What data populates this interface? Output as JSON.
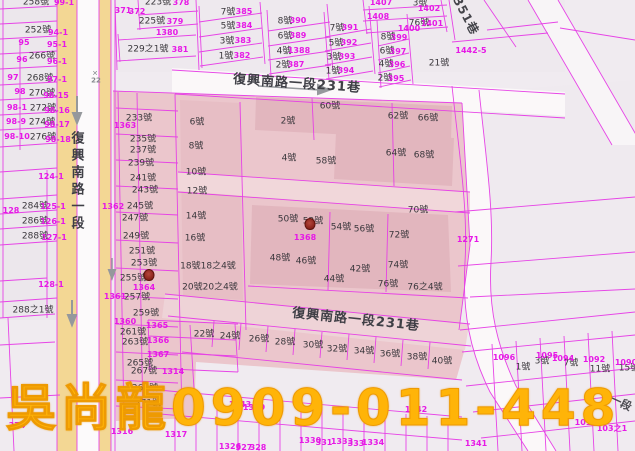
{
  "watermark": {
    "text": "吳尚龍0909-011-448",
    "color": "#ffb408"
  },
  "map_meta": {
    "highlight_color": "#ebc6cc",
    "parcel_line_color": "#e63ce6",
    "road_fill_color": "#f3d794",
    "house_label_color": "#3a373c",
    "lot_label_color": "#e619e6"
  },
  "markers": [
    {
      "x": 149,
      "y": 275
    },
    {
      "x": 310,
      "y": 224
    }
  ],
  "labels": [
    {
      "t": "復興南路一段",
      "x": 76,
      "y": 182,
      "k": "rv"
    },
    {
      "t": "復興南路一段231巷",
      "x": 297,
      "y": 84,
      "k": "road",
      "r": 4
    },
    {
      "t": "復興南路一段231巷",
      "x": 356,
      "y": 320,
      "k": "road",
      "r": 6
    },
    {
      "t": "351巷",
      "x": 466,
      "y": 16,
      "k": "lane",
      "r": 62
    },
    {
      "t": "一段",
      "x": 621,
      "y": 403,
      "k": "lane2",
      "r": 25
    },
    {
      "t": "✕",
      "x": 95,
      "y": 74,
      "k": "g"
    },
    {
      "t": "22",
      "x": 96,
      "y": 81,
      "k": "g"
    },
    {
      "t": "258號",
      "x": 36,
      "y": 3,
      "k": "h"
    },
    {
      "t": "252號",
      "x": 38,
      "y": 31,
      "k": "h"
    },
    {
      "t": "266號",
      "x": 42,
      "y": 57,
      "k": "h"
    },
    {
      "t": "268號",
      "x": 40,
      "y": 79,
      "k": "h"
    },
    {
      "t": "270號",
      "x": 42,
      "y": 94,
      "k": "h"
    },
    {
      "t": "272號",
      "x": 43,
      "y": 109,
      "k": "h"
    },
    {
      "t": "274號",
      "x": 42,
      "y": 123,
      "k": "h"
    },
    {
      "t": "276號",
      "x": 43,
      "y": 138,
      "k": "h"
    },
    {
      "t": "284號",
      "x": 35,
      "y": 207,
      "k": "h"
    },
    {
      "t": "286號",
      "x": 35,
      "y": 222,
      "k": "h"
    },
    {
      "t": "288號",
      "x": 35,
      "y": 237,
      "k": "h"
    },
    {
      "t": "288之1號",
      "x": 33,
      "y": 311,
      "k": "h"
    },
    {
      "t": "223號",
      "x": 158,
      "y": 3,
      "k": "h"
    },
    {
      "t": "225號",
      "x": 152,
      "y": 22,
      "k": "h"
    },
    {
      "t": "229之1號",
      "x": 148,
      "y": 50,
      "k": "h"
    },
    {
      "t": "233號",
      "x": 139,
      "y": 119,
      "k": "h"
    },
    {
      "t": "235號",
      "x": 143,
      "y": 140,
      "k": "h"
    },
    {
      "t": "237號",
      "x": 143,
      "y": 151,
      "k": "h"
    },
    {
      "t": "239號",
      "x": 141,
      "y": 164,
      "k": "h"
    },
    {
      "t": "241號",
      "x": 143,
      "y": 179,
      "k": "h"
    },
    {
      "t": "243號",
      "x": 145,
      "y": 191,
      "k": "h"
    },
    {
      "t": "245號",
      "x": 140,
      "y": 207,
      "k": "h"
    },
    {
      "t": "247號",
      "x": 135,
      "y": 219,
      "k": "h"
    },
    {
      "t": "249號",
      "x": 136,
      "y": 237,
      "k": "h"
    },
    {
      "t": "251號",
      "x": 142,
      "y": 252,
      "k": "h"
    },
    {
      "t": "253號",
      "x": 144,
      "y": 264,
      "k": "h"
    },
    {
      "t": "255號",
      "x": 133,
      "y": 279,
      "k": "h"
    },
    {
      "t": "257號",
      "x": 137,
      "y": 298,
      "k": "h"
    },
    {
      "t": "259號",
      "x": 146,
      "y": 314,
      "k": "h"
    },
    {
      "t": "261號",
      "x": 133,
      "y": 333,
      "k": "h"
    },
    {
      "t": "263號",
      "x": 135,
      "y": 343,
      "k": "h"
    },
    {
      "t": "265號",
      "x": 140,
      "y": 364,
      "k": "h"
    },
    {
      "t": "267號",
      "x": 144,
      "y": 372,
      "k": "h"
    },
    {
      "t": "269號",
      "x": 145,
      "y": 389,
      "k": "h"
    },
    {
      "t": "271號",
      "x": 148,
      "y": 404,
      "k": "h"
    },
    {
      "t": "6號",
      "x": 197,
      "y": 123,
      "k": "h"
    },
    {
      "t": "8號",
      "x": 196,
      "y": 147,
      "k": "h"
    },
    {
      "t": "10號",
      "x": 196,
      "y": 173,
      "k": "h"
    },
    {
      "t": "12號",
      "x": 197,
      "y": 192,
      "k": "h"
    },
    {
      "t": "14號",
      "x": 196,
      "y": 217,
      "k": "h"
    },
    {
      "t": "16號",
      "x": 195,
      "y": 239,
      "k": "h"
    },
    {
      "t": "18號18之4號",
      "x": 208,
      "y": 267,
      "k": "h"
    },
    {
      "t": "20號20之4號",
      "x": 210,
      "y": 288,
      "k": "h"
    },
    {
      "t": "2號",
      "x": 288,
      "y": 122,
      "k": "h"
    },
    {
      "t": "4號",
      "x": 289,
      "y": 159,
      "k": "h"
    },
    {
      "t": "58號",
      "x": 326,
      "y": 162,
      "k": "h"
    },
    {
      "t": "60號",
      "x": 330,
      "y": 107,
      "k": "h"
    },
    {
      "t": "62號",
      "x": 398,
      "y": 117,
      "k": "h"
    },
    {
      "t": "66號",
      "x": 428,
      "y": 119,
      "k": "h"
    },
    {
      "t": "64號",
      "x": 396,
      "y": 154,
      "k": "h"
    },
    {
      "t": "68號",
      "x": 424,
      "y": 156,
      "k": "h"
    },
    {
      "t": "70號",
      "x": 418,
      "y": 211,
      "k": "h"
    },
    {
      "t": "72號",
      "x": 399,
      "y": 236,
      "k": "h"
    },
    {
      "t": "50號",
      "x": 288,
      "y": 220,
      "k": "h"
    },
    {
      "t": "52號",
      "x": 313,
      "y": 222,
      "k": "h"
    },
    {
      "t": "54號",
      "x": 341,
      "y": 228,
      "k": "h"
    },
    {
      "t": "56號",
      "x": 364,
      "y": 230,
      "k": "h"
    },
    {
      "t": "48號",
      "x": 280,
      "y": 259,
      "k": "h"
    },
    {
      "t": "46號",
      "x": 306,
      "y": 262,
      "k": "h"
    },
    {
      "t": "42號",
      "x": 360,
      "y": 270,
      "k": "h"
    },
    {
      "t": "74號",
      "x": 398,
      "y": 266,
      "k": "h"
    },
    {
      "t": "44號",
      "x": 334,
      "y": 280,
      "k": "h"
    },
    {
      "t": "76號",
      "x": 388,
      "y": 285,
      "k": "h"
    },
    {
      "t": "76之4號",
      "x": 425,
      "y": 288,
      "k": "h"
    },
    {
      "t": "22號",
      "x": 204,
      "y": 335,
      "k": "h"
    },
    {
      "t": "24號",
      "x": 230,
      "y": 337,
      "k": "h"
    },
    {
      "t": "26號",
      "x": 259,
      "y": 340,
      "k": "h"
    },
    {
      "t": "28號",
      "x": 285,
      "y": 343,
      "k": "h"
    },
    {
      "t": "30號",
      "x": 313,
      "y": 346,
      "k": "h"
    },
    {
      "t": "32號",
      "x": 337,
      "y": 350,
      "k": "h"
    },
    {
      "t": "34號",
      "x": 364,
      "y": 352,
      "k": "h"
    },
    {
      "t": "36號",
      "x": 390,
      "y": 355,
      "k": "h"
    },
    {
      "t": "38號",
      "x": 417,
      "y": 358,
      "k": "h"
    },
    {
      "t": "40號",
      "x": 442,
      "y": 362,
      "k": "h"
    },
    {
      "t": "7號",
      "x": 228,
      "y": 13,
      "k": "h"
    },
    {
      "t": "5號",
      "x": 228,
      "y": 27,
      "k": "h"
    },
    {
      "t": "3號",
      "x": 227,
      "y": 42,
      "k": "h"
    },
    {
      "t": "1號",
      "x": 226,
      "y": 57,
      "k": "h"
    },
    {
      "t": "8號",
      "x": 285,
      "y": 22,
      "k": "h"
    },
    {
      "t": "6號",
      "x": 285,
      "y": 37,
      "k": "h"
    },
    {
      "t": "4號",
      "x": 284,
      "y": 52,
      "k": "h"
    },
    {
      "t": "2號",
      "x": 283,
      "y": 66,
      "k": "h"
    },
    {
      "t": "7號",
      "x": 337,
      "y": 29,
      "k": "h"
    },
    {
      "t": "5號",
      "x": 336,
      "y": 44,
      "k": "h"
    },
    {
      "t": "3號",
      "x": 334,
      "y": 58,
      "k": "h"
    },
    {
      "t": "1號",
      "x": 333,
      "y": 72,
      "k": "h"
    },
    {
      "t": "8號",
      "x": 388,
      "y": 38,
      "k": "h"
    },
    {
      "t": "6號",
      "x": 387,
      "y": 52,
      "k": "h"
    },
    {
      "t": "4號",
      "x": 386,
      "y": 65,
      "k": "h"
    },
    {
      "t": "2號",
      "x": 385,
      "y": 79,
      "k": "h"
    },
    {
      "t": "21號",
      "x": 439,
      "y": 64,
      "k": "h"
    },
    {
      "t": "3號",
      "x": 420,
      "y": 4,
      "k": "h"
    },
    {
      "t": "76號",
      "x": 419,
      "y": 24,
      "k": "h"
    },
    {
      "t": "1號",
      "x": 523,
      "y": 368,
      "k": "h"
    },
    {
      "t": "3號",
      "x": 542,
      "y": 362,
      "k": "h"
    },
    {
      "t": "7號",
      "x": 571,
      "y": 364,
      "k": "h"
    },
    {
      "t": "11號",
      "x": 600,
      "y": 370,
      "k": "h"
    },
    {
      "t": "15號",
      "x": 629,
      "y": 369,
      "k": "h"
    },
    {
      "t": "99-1",
      "x": 64,
      "y": 3,
      "k": "p"
    },
    {
      "t": "94-1",
      "x": 58,
      "y": 33,
      "k": "p"
    },
    {
      "t": "95",
      "x": 24,
      "y": 43,
      "k": "p"
    },
    {
      "t": "95-1",
      "x": 57,
      "y": 45,
      "k": "p"
    },
    {
      "t": "96",
      "x": 22,
      "y": 60,
      "k": "p"
    },
    {
      "t": "96-1",
      "x": 57,
      "y": 62,
      "k": "p"
    },
    {
      "t": "97",
      "x": 13,
      "y": 78,
      "k": "p"
    },
    {
      "t": "97-1",
      "x": 57,
      "y": 80,
      "k": "p"
    },
    {
      "t": "98",
      "x": 20,
      "y": 92,
      "k": "p"
    },
    {
      "t": "98-15",
      "x": 56,
      "y": 96,
      "k": "p"
    },
    {
      "t": "98-1",
      "x": 17,
      "y": 108,
      "k": "p"
    },
    {
      "t": "98-16",
      "x": 57,
      "y": 111,
      "k": "p"
    },
    {
      "t": "98-9",
      "x": 16,
      "y": 122,
      "k": "p"
    },
    {
      "t": "98-17",
      "x": 57,
      "y": 125,
      "k": "p"
    },
    {
      "t": "98-10",
      "x": 17,
      "y": 137,
      "k": "p"
    },
    {
      "t": "98-18",
      "x": 58,
      "y": 140,
      "k": "p"
    },
    {
      "t": "124-1",
      "x": 51,
      "y": 177,
      "k": "p"
    },
    {
      "t": "125-1",
      "x": 53,
      "y": 207,
      "k": "p"
    },
    {
      "t": "126-1",
      "x": 53,
      "y": 222,
      "k": "p"
    },
    {
      "t": "127-1",
      "x": 54,
      "y": 238,
      "k": "p"
    },
    {
      "t": "128",
      "x": 11,
      "y": 211,
      "k": "p"
    },
    {
      "t": "128-1",
      "x": 51,
      "y": 285,
      "k": "p"
    },
    {
      "t": "374",
      "x": 17,
      "y": 426,
      "k": "p"
    },
    {
      "t": "371",
      "x": 123,
      "y": 11,
      "k": "p"
    },
    {
      "t": "372",
      "x": 137,
      "y": 12,
      "k": "p"
    },
    {
      "t": "378",
      "x": 181,
      "y": 3,
      "k": "p"
    },
    {
      "t": "379",
      "x": 175,
      "y": 22,
      "k": "p"
    },
    {
      "t": "1380",
      "x": 167,
      "y": 33,
      "k": "p"
    },
    {
      "t": "381",
      "x": 180,
      "y": 50,
      "k": "p"
    },
    {
      "t": "385",
      "x": 244,
      "y": 12,
      "k": "p"
    },
    {
      "t": "384",
      "x": 244,
      "y": 26,
      "k": "p"
    },
    {
      "t": "383",
      "x": 243,
      "y": 41,
      "k": "p"
    },
    {
      "t": "382",
      "x": 242,
      "y": 56,
      "k": "p"
    },
    {
      "t": "390",
      "x": 298,
      "y": 21,
      "k": "p"
    },
    {
      "t": "389",
      "x": 298,
      "y": 36,
      "k": "p"
    },
    {
      "t": "1388",
      "x": 299,
      "y": 51,
      "k": "p"
    },
    {
      "t": "387",
      "x": 296,
      "y": 65,
      "k": "p"
    },
    {
      "t": "391",
      "x": 350,
      "y": 28,
      "k": "p"
    },
    {
      "t": "392",
      "x": 349,
      "y": 43,
      "k": "p"
    },
    {
      "t": "393",
      "x": 347,
      "y": 57,
      "k": "p"
    },
    {
      "t": "394",
      "x": 346,
      "y": 71,
      "k": "p"
    },
    {
      "t": "399",
      "x": 399,
      "y": 38,
      "k": "p"
    },
    {
      "t": "397",
      "x": 398,
      "y": 52,
      "k": "p"
    },
    {
      "t": "396",
      "x": 397,
      "y": 65,
      "k": "p"
    },
    {
      "t": "395",
      "x": 396,
      "y": 79,
      "k": "p"
    },
    {
      "t": "1407",
      "x": 381,
      "y": 3,
      "k": "p"
    },
    {
      "t": "1408",
      "x": 378,
      "y": 17,
      "k": "p"
    },
    {
      "t": "1402",
      "x": 429,
      "y": 9,
      "k": "p"
    },
    {
      "t": "1401",
      "x": 432,
      "y": 24,
      "k": "p"
    },
    {
      "t": "1400",
      "x": 409,
      "y": 29,
      "k": "p"
    },
    {
      "t": "1442-5",
      "x": 471,
      "y": 51,
      "k": "p"
    },
    {
      "t": "1363",
      "x": 125,
      "y": 126,
      "k": "p"
    },
    {
      "t": "1362",
      "x": 113,
      "y": 207,
      "k": "p"
    },
    {
      "t": "1361",
      "x": 115,
      "y": 297,
      "k": "p"
    },
    {
      "t": "1364",
      "x": 144,
      "y": 288,
      "k": "p"
    },
    {
      "t": "1360",
      "x": 125,
      "y": 322,
      "k": "p"
    },
    {
      "t": "1365",
      "x": 157,
      "y": 326,
      "k": "p"
    },
    {
      "t": "1366",
      "x": 158,
      "y": 341,
      "k": "p"
    },
    {
      "t": "1367",
      "x": 158,
      "y": 355,
      "k": "p"
    },
    {
      "t": "1314",
      "x": 173,
      "y": 372,
      "k": "p"
    },
    {
      "t": "1316",
      "x": 122,
      "y": 432,
      "k": "p"
    },
    {
      "t": "1317",
      "x": 176,
      "y": 435,
      "k": "p"
    },
    {
      "t": "1368",
      "x": 305,
      "y": 238,
      "k": "p"
    },
    {
      "t": "1271",
      "x": 468,
      "y": 240,
      "k": "p"
    },
    {
      "t": "1096",
      "x": 504,
      "y": 358,
      "k": "p"
    },
    {
      "t": "1095",
      "x": 547,
      "y": 356,
      "k": "p"
    },
    {
      "t": "1094",
      "x": 563,
      "y": 359,
      "k": "p"
    },
    {
      "t": "1092",
      "x": 594,
      "y": 360,
      "k": "p"
    },
    {
      "t": "1090",
      "x": 626,
      "y": 363,
      "k": "p"
    },
    {
      "t": "101",
      "x": 583,
      "y": 423,
      "k": "p"
    },
    {
      "t": "103之1",
      "x": 612,
      "y": 429,
      "k": "p"
    },
    {
      "t": "1341",
      "x": 476,
      "y": 444,
      "k": "p"
    },
    {
      "t": "1342",
      "x": 416,
      "y": 410,
      "k": "p"
    },
    {
      "t": "1343",
      "x": 240,
      "y": 405,
      "k": "p"
    },
    {
      "t": "1349",
      "x": 254,
      "y": 408,
      "k": "p"
    },
    {
      "t": "1326",
      "x": 230,
      "y": 447,
      "k": "p"
    },
    {
      "t": "327",
      "x": 244,
      "y": 448,
      "k": "p"
    },
    {
      "t": "328",
      "x": 258,
      "y": 448,
      "k": "p"
    },
    {
      "t": "1330",
      "x": 310,
      "y": 441,
      "k": "p"
    },
    {
      "t": "331",
      "x": 324,
      "y": 443,
      "k": "p"
    },
    {
      "t": "1333",
      "x": 342,
      "y": 442,
      "k": "p"
    },
    {
      "t": "333",
      "x": 356,
      "y": 444,
      "k": "p"
    },
    {
      "t": "1334",
      "x": 373,
      "y": 443,
      "k": "p"
    }
  ]
}
